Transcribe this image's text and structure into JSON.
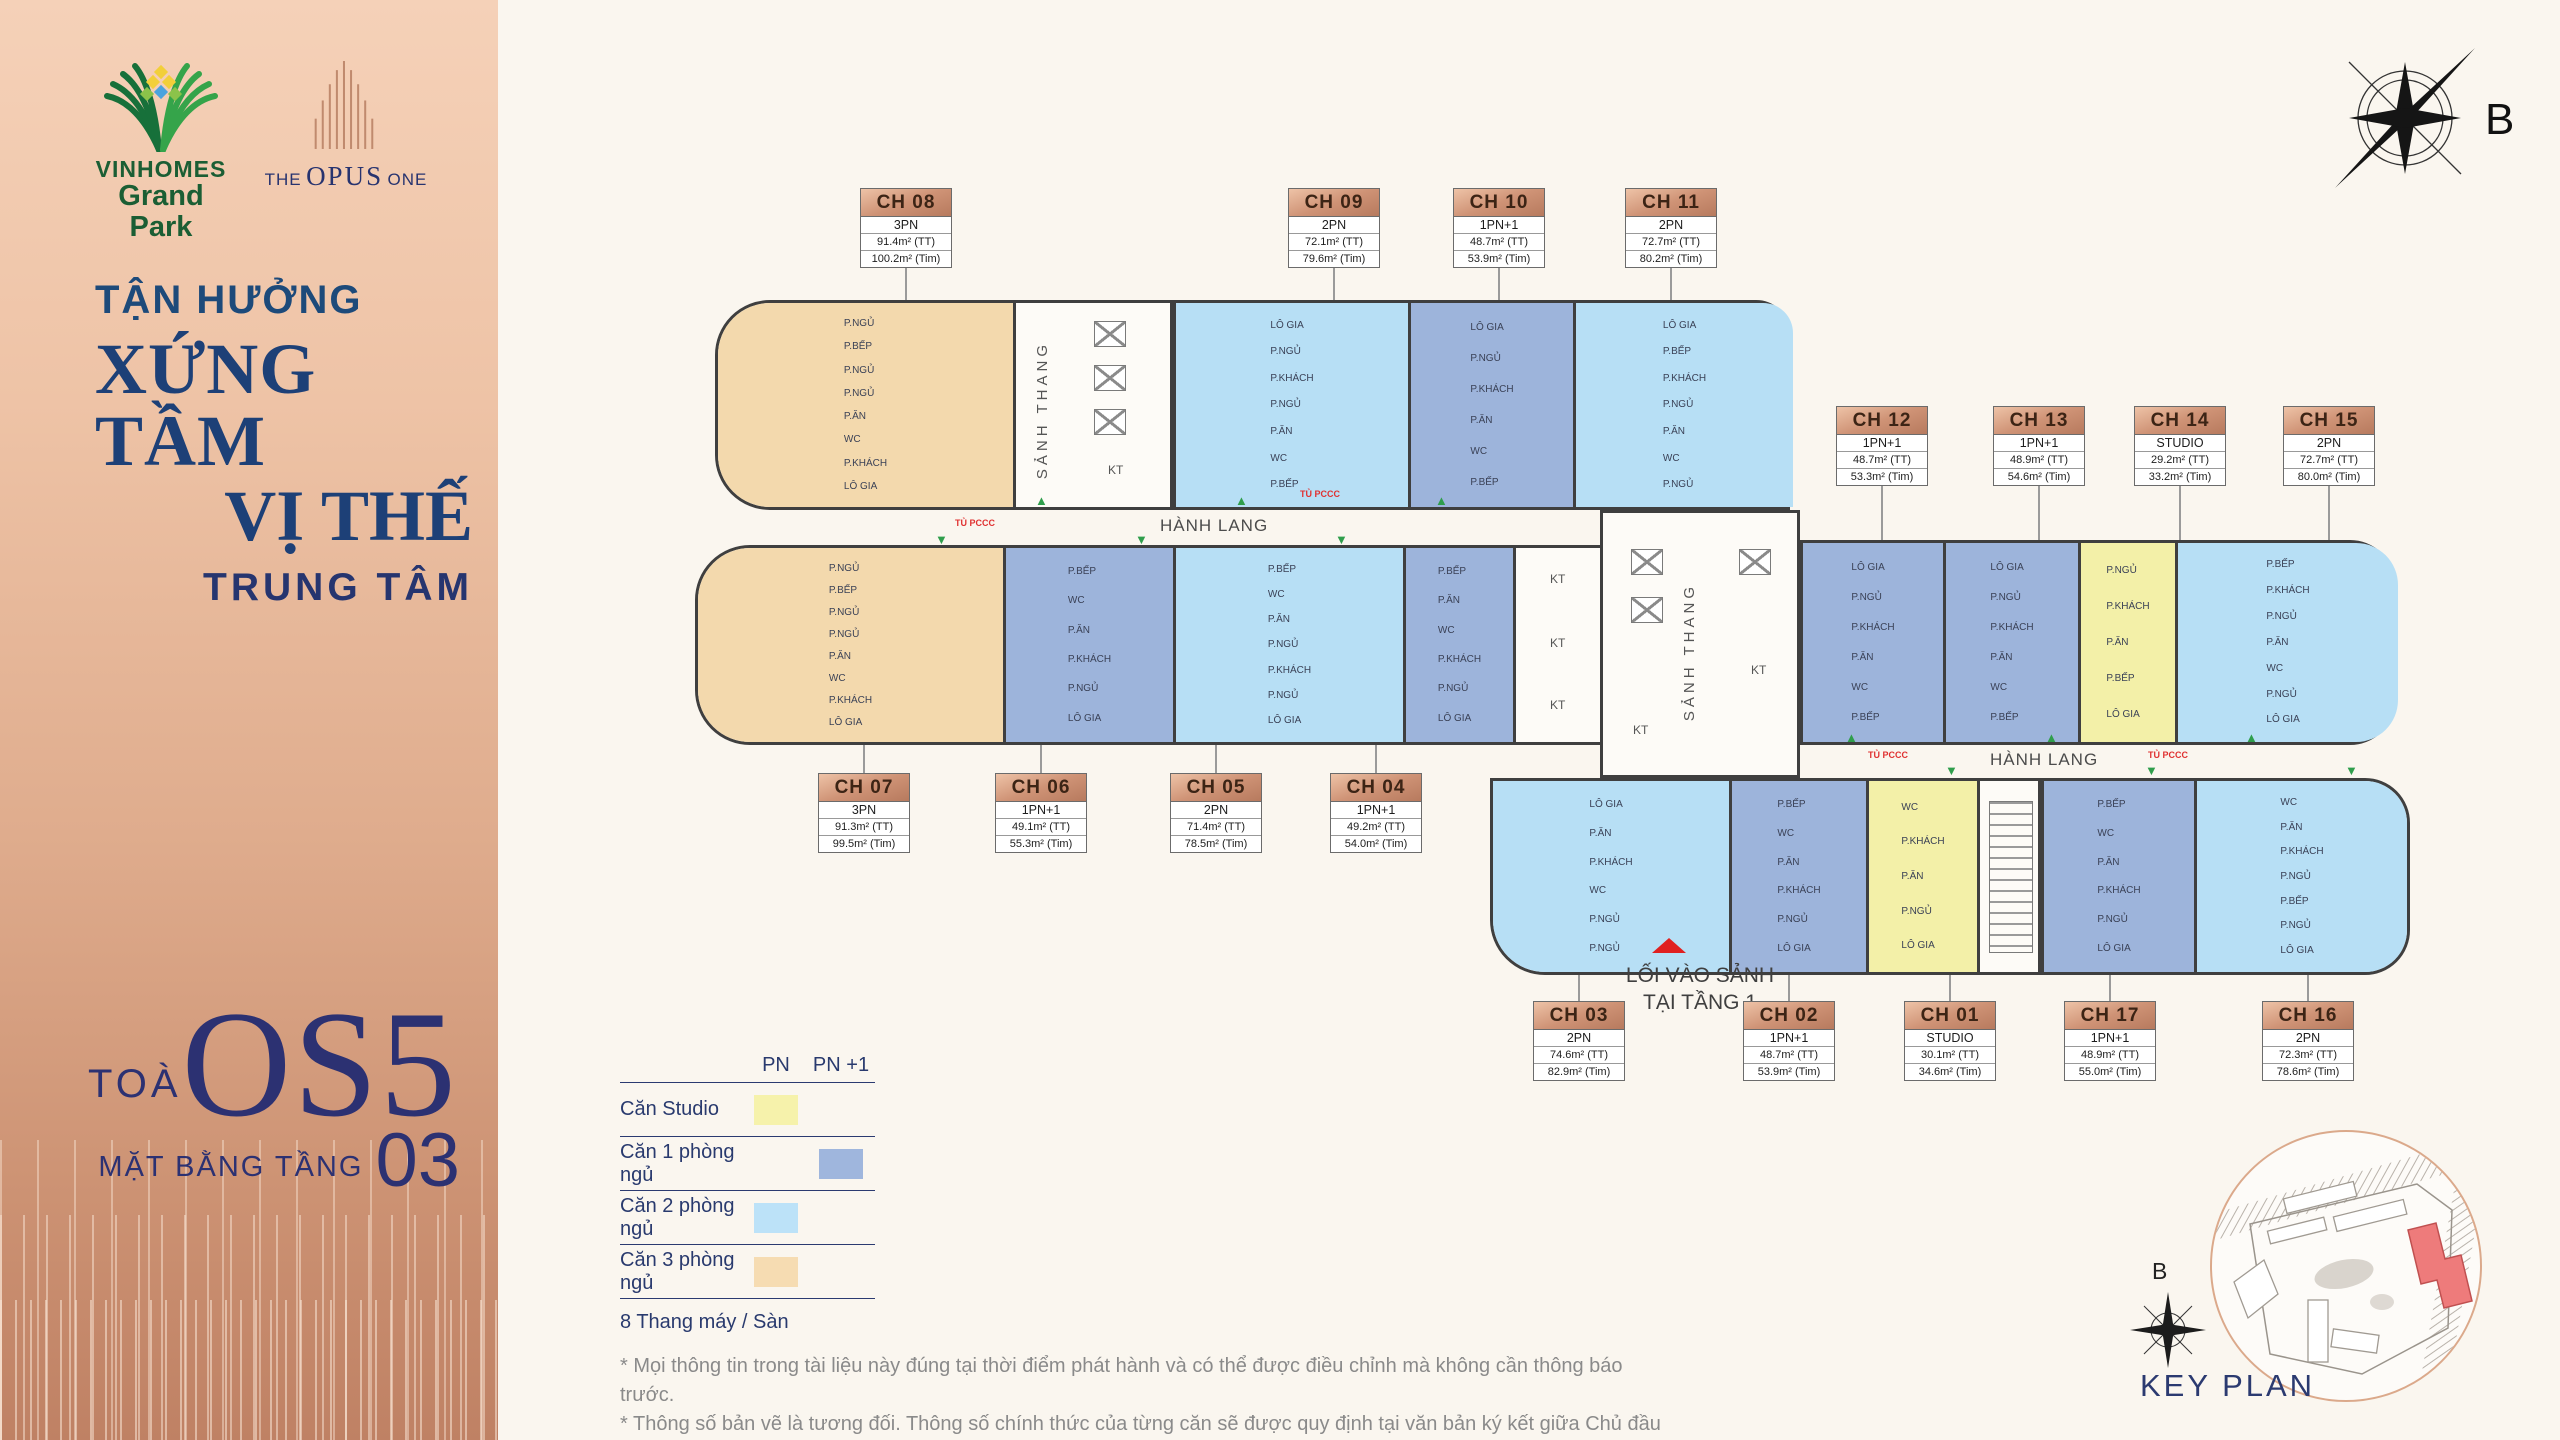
{
  "branding": {
    "vinhomes": {
      "name": "VINHOMES",
      "sub": "Grand Park"
    },
    "opus": {
      "the": "THE",
      "opus": "OPUS",
      "one": "ONE"
    }
  },
  "sidebar": {
    "tagline_line1": "TẬN HƯỞNG",
    "tagline_line2": "XỨNG TẦM",
    "tagline_line3": "VỊ THẾ",
    "tagline_line4": "TRUNG TÂM",
    "tower_prefix": "TOÀ",
    "tower_name": "OS5",
    "floor_label": "MẶT BẰNG TẦNG",
    "floor_number": "03"
  },
  "compass": {
    "north_label": "B"
  },
  "plan": {
    "corridor_label": "HÀNH LANG",
    "lobby_label": "SẢNH THANG",
    "shaft_label": "KT",
    "fire_cabinet_label": "TỦ PCCC",
    "entry_line1": "LỐI VÀO SẢNH",
    "entry_line2": "TẠI TẦNG 1",
    "wall_color": "#3f3f3f",
    "units": {
      "ch01": {
        "rooms": [
          "WC",
          "P.KHÁCH",
          "P.ĂN",
          "P.NGỦ",
          "LÔ GIA"
        ]
      },
      "ch02": {
        "rooms": [
          "P.BẾP",
          "WC",
          "P.ĂN",
          "P.KHÁCH",
          "P.NGỦ",
          "LÔ GIA"
        ]
      },
      "ch03": {
        "rooms": [
          "LÔ GIA",
          "P.ĂN",
          "P.KHÁCH",
          "WC",
          "P.NGỦ",
          "P.NGỦ"
        ]
      },
      "ch04": {
        "rooms": [
          "P.BẾP",
          "P.ĂN",
          "WC",
          "P.KHÁCH",
          "P.NGỦ",
          "LÔ GIA"
        ]
      },
      "ch05": {
        "rooms": [
          "P.BẾP",
          "WC",
          "P.ĂN",
          "P.NGỦ",
          "P.KHÁCH",
          "P.NGỦ",
          "LÔ GIA"
        ]
      },
      "ch06": {
        "rooms": [
          "P.BẾP",
          "WC",
          "P.ĂN",
          "P.KHÁCH",
          "P.NGỦ",
          "LÔ GIA"
        ]
      },
      "ch07": {
        "rooms": [
          "P.NGỦ",
          "P.BẾP",
          "P.NGỦ",
          "P.NGỦ",
          "P.ĂN",
          "WC",
          "P.KHÁCH",
          "LÔ GIA"
        ]
      },
      "ch08": {
        "rooms": [
          "P.NGỦ",
          "P.BẾP",
          "P.NGỦ",
          "P.NGỦ",
          "P.ĂN",
          "WC",
          "P.KHÁCH",
          "LÔ GIA"
        ]
      },
      "ch09": {
        "rooms": [
          "LÔ GIA",
          "P.NGỦ",
          "P.KHÁCH",
          "P.NGỦ",
          "P.ĂN",
          "WC",
          "P.BẾP"
        ]
      },
      "ch10": {
        "rooms": [
          "LÔ GIA",
          "P.NGỦ",
          "P.KHÁCH",
          "P.ĂN",
          "WC",
          "P.BẾP"
        ]
      },
      "ch11": {
        "rooms": [
          "LÔ GIA",
          "P.BẾP",
          "P.KHÁCH",
          "P.NGỦ",
          "P.ĂN",
          "WC",
          "P.NGỦ"
        ]
      },
      "ch12": {
        "rooms": [
          "LÔ GIA",
          "P.NGỦ",
          "P.KHÁCH",
          "P.ĂN",
          "WC",
          "P.BẾP"
        ]
      },
      "ch13": {
        "rooms": [
          "LÔ GIA",
          "P.NGỦ",
          "P.KHÁCH",
          "P.ĂN",
          "WC",
          "P.BẾP"
        ]
      },
      "ch14": {
        "rooms": [
          "P.NGỦ",
          "P.KHÁCH",
          "P.ĂN",
          "P.BẾP",
          "LÔ GIA"
        ]
      },
      "ch15": {
        "rooms": [
          "P.BẾP",
          "P.KHÁCH",
          "P.NGỦ",
          "P.ĂN",
          "WC",
          "P.NGỦ",
          "LÔ GIA"
        ]
      },
      "ch16": {
        "rooms": [
          "WC",
          "P.ĂN",
          "P.KHÁCH",
          "P.NGỦ",
          "P.BẾP",
          "P.NGỦ",
          "LÔ GIA"
        ]
      },
      "ch17": {
        "rooms": [
          "P.BẾP",
          "WC",
          "P.ĂN",
          "P.KHÁCH",
          "P.NGỦ",
          "LÔ GIA"
        ]
      }
    }
  },
  "unit_labels": {
    "ch01": {
      "id": "CH 01",
      "type": "STUDIO",
      "area_tt": "30.1m²  (TT)",
      "area_tim": "34.6m²  (Tim)"
    },
    "ch02": {
      "id": "CH 02",
      "type": "1PN+1",
      "area_tt": "48.7m²  (TT)",
      "area_tim": "53.9m²  (Tim)"
    },
    "ch03": {
      "id": "CH 03",
      "type": "2PN",
      "area_tt": "74.6m²  (TT)",
      "area_tim": "82.9m²  (Tim)"
    },
    "ch04": {
      "id": "CH 04",
      "type": "1PN+1",
      "area_tt": "49.2m²  (TT)",
      "area_tim": "54.0m²  (Tim)"
    },
    "ch05": {
      "id": "CH 05",
      "type": "2PN",
      "area_tt": "71.4m²  (TT)",
      "area_tim": "78.5m²  (Tim)"
    },
    "ch06": {
      "id": "CH 06",
      "type": "1PN+1",
      "area_tt": "49.1m²  (TT)",
      "area_tim": "55.3m²  (Tim)"
    },
    "ch07": {
      "id": "CH 07",
      "type": "3PN",
      "area_tt": "91.3m²  (TT)",
      "area_tim": "99.5m²  (Tim)"
    },
    "ch08": {
      "id": "CH 08",
      "type": "3PN",
      "area_tt": "91.4m²  (TT)",
      "area_tim": "100.2m²  (Tim)"
    },
    "ch09": {
      "id": "CH 09",
      "type": "2PN",
      "area_tt": "72.1m²  (TT)",
      "area_tim": "79.6m²  (Tim)"
    },
    "ch10": {
      "id": "CH 10",
      "type": "1PN+1",
      "area_tt": "48.7m²  (TT)",
      "area_tim": "53.9m²  (Tim)"
    },
    "ch11": {
      "id": "CH 11",
      "type": "2PN",
      "area_tt": "72.7m²  (TT)",
      "area_tim": "80.2m²  (Tim)"
    },
    "ch12": {
      "id": "CH 12",
      "type": "1PN+1",
      "area_tt": "48.7m²  (TT)",
      "area_tim": "53.3m²  (Tim)"
    },
    "ch13": {
      "id": "CH 13",
      "type": "1PN+1",
      "area_tt": "48.9m²  (TT)",
      "area_tim": "54.6m²  (Tim)"
    },
    "ch14": {
      "id": "CH 14",
      "type": "STUDIO",
      "area_tt": "29.2m²  (TT)",
      "area_tim": "33.2m²  (Tim)"
    },
    "ch15": {
      "id": "CH 15",
      "type": "2PN",
      "area_tt": "72.7m²  (TT)",
      "area_tim": "80.0m²  (Tim)"
    },
    "ch16": {
      "id": "CH 16",
      "type": "2PN",
      "area_tt": "72.3m²  (TT)",
      "area_tim": "78.6m²  (Tim)"
    },
    "ch17": {
      "id": "CH 17",
      "type": "1PN+1",
      "area_tt": "48.9m²  (TT)",
      "area_tim": "55.0m²  (Tim)"
    }
  },
  "legend": {
    "col_pn": "PN",
    "col_pn1": "PN +1",
    "rows": [
      {
        "label": "Căn Studio",
        "color": "#f6f2ab",
        "col": "pn"
      },
      {
        "label": "Căn 1 phòng ngủ",
        "color": "#9fb6dd",
        "col": "pn1"
      },
      {
        "label": "Căn 2 phòng ngủ",
        "color": "#bce2f8",
        "col": "pn"
      },
      {
        "label": "Căn 3 phòng ngủ",
        "color": "#f6dcb2",
        "col": "pn"
      }
    ],
    "note": "8 Thang máy / Sàn"
  },
  "keyplan": {
    "title": "KEY PLAN",
    "north_label": "B",
    "highlight_color": "#ee7b7b"
  },
  "disclaimer": {
    "line1": "* Mọi thông tin trong tài liệu này đúng tại thời điểm phát hành và có thể được điều chỉnh mà không cần thông báo trước.",
    "line2": "* Thông số bản vẽ là tương đối. Thông số chính thức của từng căn sẽ được quy định tại văn bản ký kết giữa Chủ đầu tư và khách hàng."
  }
}
